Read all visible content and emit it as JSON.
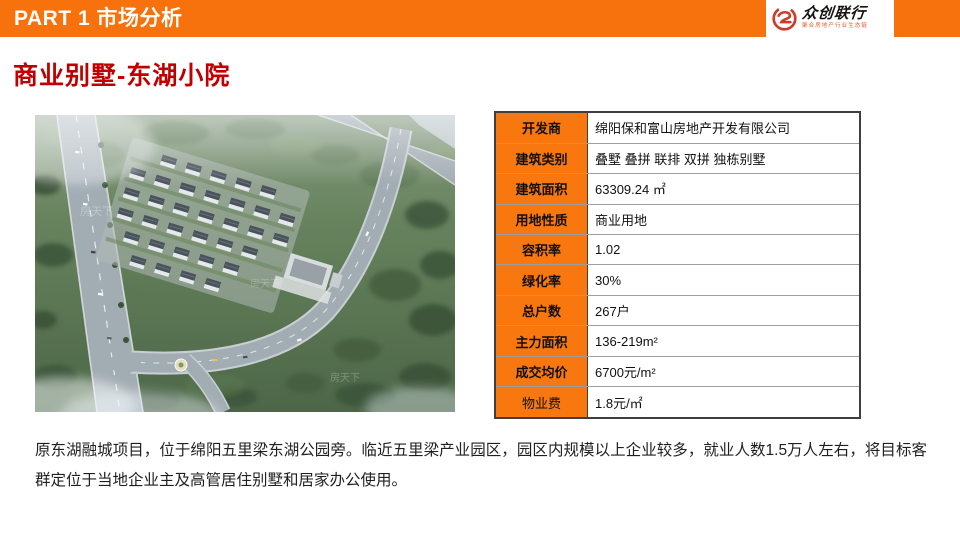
{
  "colors": {
    "top_bar_orange": "#F7720C",
    "table_header_orange": "#F8770F",
    "title_red": "#C00000",
    "logo_red": "#D03A28",
    "body_text": "#1F1F1F"
  },
  "top_bar": {
    "part_label": "PART 1 市场分析"
  },
  "logo": {
    "brand": "众创联行",
    "tagline": "聚合房地产行业生态链",
    "icon": "swirl-emblem"
  },
  "title": "商业别墅-东湖小院",
  "aerial": {
    "watermark": "房天下"
  },
  "info_table": {
    "rows": [
      {
        "label": "开发商",
        "value": "绵阳保和富山房地产开发有限公司"
      },
      {
        "label": "建筑类别",
        "value": "叠墅 叠拼 联排 双拼 独栋别墅"
      },
      {
        "label": "建筑面积",
        "value": "63309.24 ㎡"
      },
      {
        "label": "用地性质",
        "value": "商业用地"
      },
      {
        "label": "容积率",
        "value": "1.02"
      },
      {
        "label": "绿化率",
        "value": "30%"
      },
      {
        "label": "总户数",
        "value": "267户"
      },
      {
        "label": "主力面积",
        "value": "136-219m²"
      },
      {
        "label": "成交均价",
        "value": "6700元/m²"
      },
      {
        "label": "物业费",
        "value": "1.8元/㎡"
      }
    ]
  },
  "description": "原东湖融城项目，位于绵阳五里梁东湖公园旁。临近五里梁产业园区，园区内规模以上企业较多，就业人数1.5万人左右，将目标客群定位于当地企业主及高管居住别墅和居家办公使用。"
}
